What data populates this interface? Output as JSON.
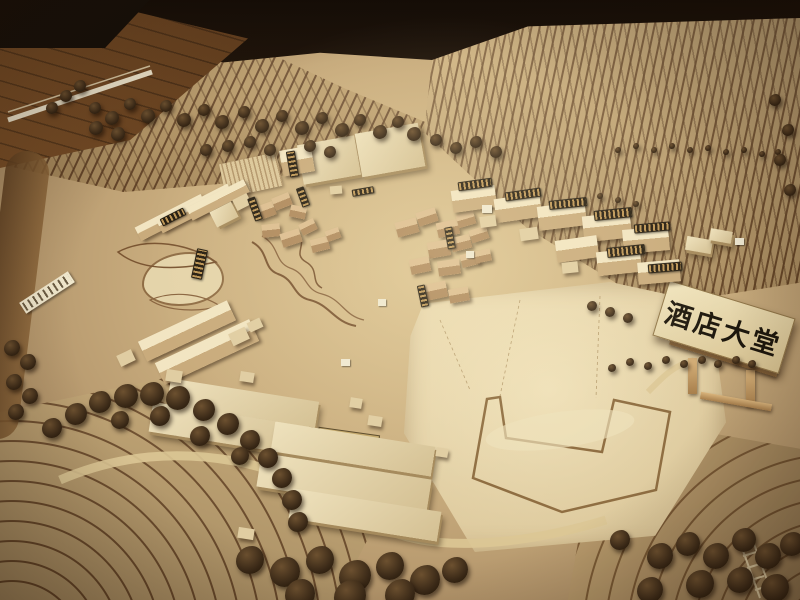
{
  "scene": {
    "description": "Photograph of a wooden architectural scale model with terraced terrain, clusters of small wooden buildings, tree clusters and labeled plaques"
  },
  "signs": {
    "hotel_lobby": {
      "text": "酒店大堂"
    },
    "building_no5": {
      "text": "伍号楼"
    },
    "building_no4": {
      "text": "肆号楼"
    }
  },
  "colors": {
    "base_tan": "#cbaf80",
    "contour_brown": "#6b4a2a",
    "plaza_pale": "#ead9b0",
    "tree_dark": "#3a2917",
    "mini_plaque_dark": "#241c10",
    "mini_plaque_gold": "#caa05c",
    "sign_cream": "#f0e4be",
    "sign_text": "#1d170d",
    "background_dark": "#140d07"
  }
}
